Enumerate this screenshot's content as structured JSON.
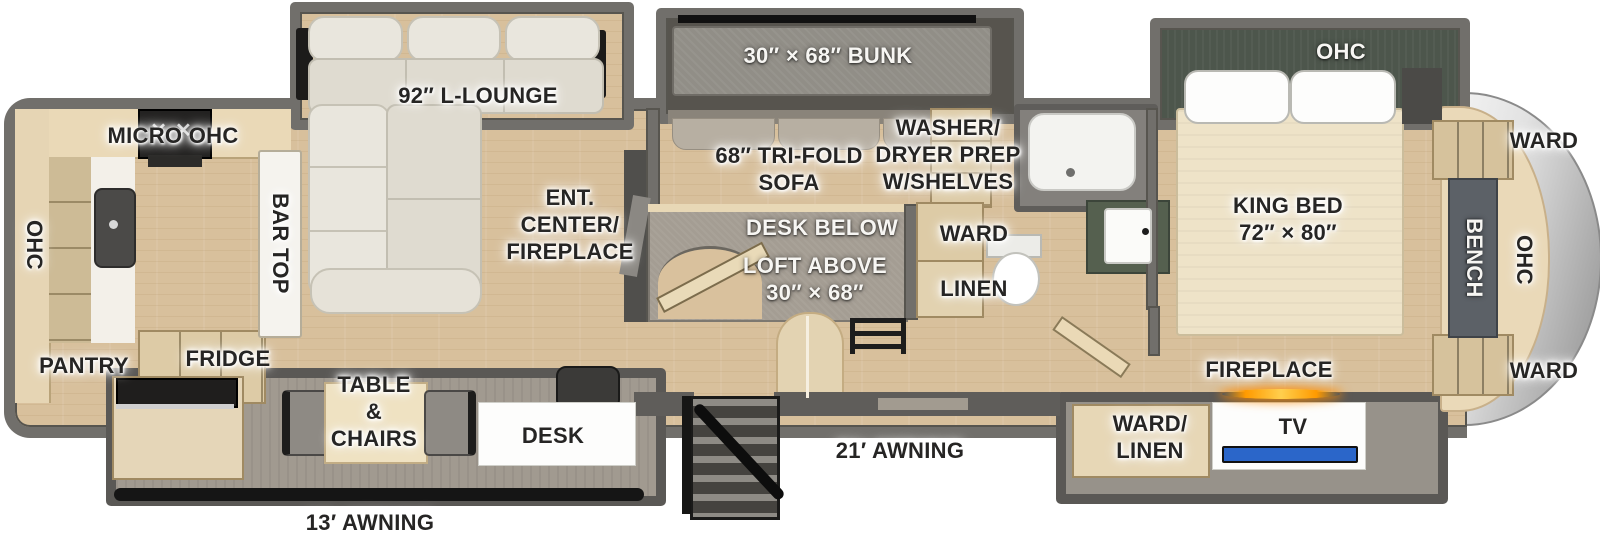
{
  "floorplan": {
    "exterior": {
      "awning_front": "21′ AWNING",
      "awning_rear": "13′ AWNING"
    },
    "kitchen": {
      "micro_ohc": "MICRO  OHC",
      "ohc": "OHC",
      "pantry": "PANTRY",
      "bar_top": "BAR TOP"
    },
    "dinette_slide": {
      "fridge": "FRIDGE",
      "table_chairs": "TABLE\n&\nCHAIRS",
      "desk": "DESK"
    },
    "living": {
      "lounge": "92″ L-LOUNGE",
      "ent_center": "ENT.\nCENTER/\nFIREPLACE"
    },
    "loft_room": {
      "bunk": "30″ × 68″ BUNK",
      "sofa": "68″ TRI-FOLD\nSOFA",
      "desk_below": "DESK BELOW",
      "loft_above": "LOFT ABOVE\n30″ × 68″"
    },
    "bath": {
      "washer_dryer": "WASHER/\nDRYER PREP\nW/SHELVES",
      "ward": "WARD",
      "linen": "LINEN"
    },
    "bedroom": {
      "king_bed": "KING BED\n72″ × 80″",
      "ohc_slide": "OHC",
      "fireplace": "FIREPLACE",
      "ward_linen": "WARD/\nLINEN",
      "tv": "TV"
    },
    "front_cap": {
      "ward_top": "WARD",
      "ohc": "OHC",
      "bench": "BENCH",
      "ward_bottom": "WARD"
    }
  },
  "colors": {
    "wall": "#716f6b",
    "floor": "#d8c09c",
    "slide_dark_interior": "#57544e",
    "bed_slide_green": "#4d564c",
    "cap_silver": "#d9d9d9",
    "awning_bar": "#151515",
    "tv_screen": "#2b66c9",
    "fireplace_glow": "#ff9a00"
  }
}
